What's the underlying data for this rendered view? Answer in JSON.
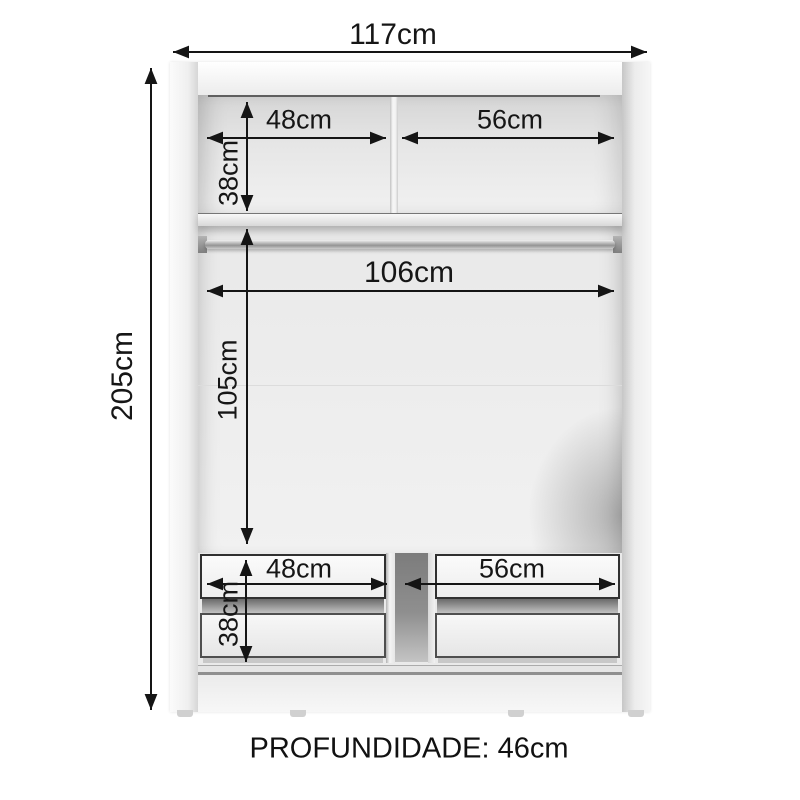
{
  "diagram": {
    "type": "furniture-dimension-diagram",
    "subject": "wardrobe-internal-layout",
    "dims": {
      "width_total": "117cm",
      "height_total": "205cm",
      "top_left": "48cm",
      "top_right": "56cm",
      "top_height": "38cm",
      "rod_span": "106cm",
      "middle_height": "105cm",
      "bottom_left": "48cm",
      "bottom_right": "56cm",
      "bottom_height": "38cm"
    },
    "footer": {
      "depth": "PROFUNDIDADE: 46cm"
    },
    "colors": {
      "background": "#ffffff",
      "line": "#151515",
      "body": "#f5f5f5",
      "interior": "#e8e8e8",
      "rod_metal": "#949494",
      "drawer_outline": "#303030"
    }
  }
}
